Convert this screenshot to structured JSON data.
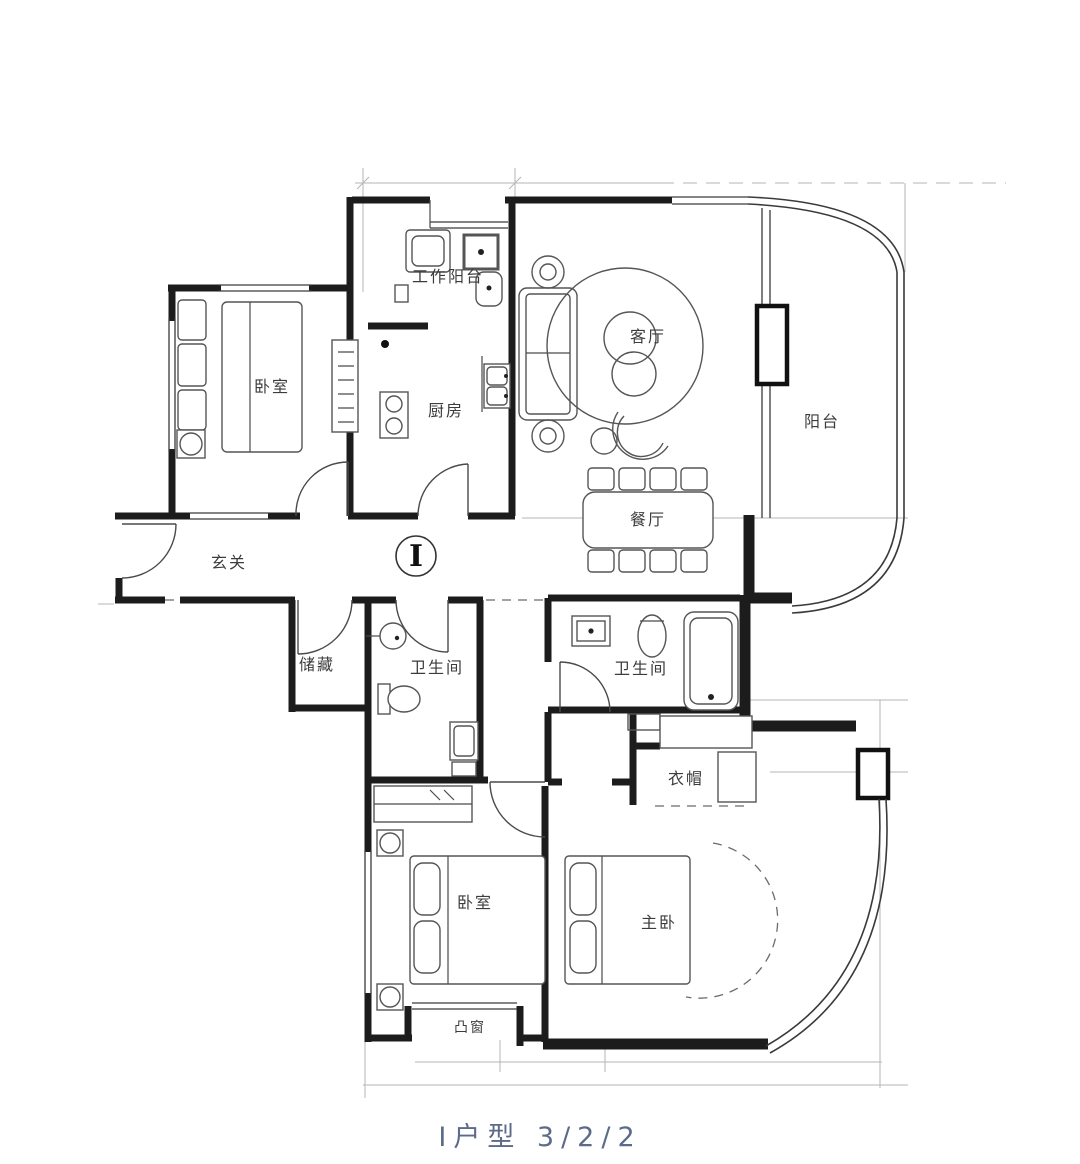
{
  "meta": {
    "caption": "I户型 3/2/2",
    "unit_marker": "I",
    "drawing_type": "apartment floor plan"
  },
  "colors": {
    "wall": "#1c1c1c",
    "furniture_line": "#555555",
    "construction_line": "#b5b5b5",
    "caption": "#5c6b88",
    "paper": "#ffffff"
  },
  "rooms": [
    {
      "id": "work-balcony",
      "label": "工作阳台"
    },
    {
      "id": "living-room",
      "label": "客厅"
    },
    {
      "id": "balcony",
      "label": "阳台"
    },
    {
      "id": "bedroom-top-left",
      "label": "卧室"
    },
    {
      "id": "kitchen",
      "label": "厨房"
    },
    {
      "id": "dining-room",
      "label": "餐厅"
    },
    {
      "id": "entry-hall",
      "label": "玄关"
    },
    {
      "id": "storage",
      "label": "储藏"
    },
    {
      "id": "bathroom-left",
      "label": "卫生间"
    },
    {
      "id": "bathroom-right",
      "label": "卫生间"
    },
    {
      "id": "cloakroom",
      "label": "衣帽"
    },
    {
      "id": "bedroom-bottom",
      "label": "卧室"
    },
    {
      "id": "master-bedroom",
      "label": "主卧"
    },
    {
      "id": "bay-window",
      "label": "凸窗"
    }
  ]
}
